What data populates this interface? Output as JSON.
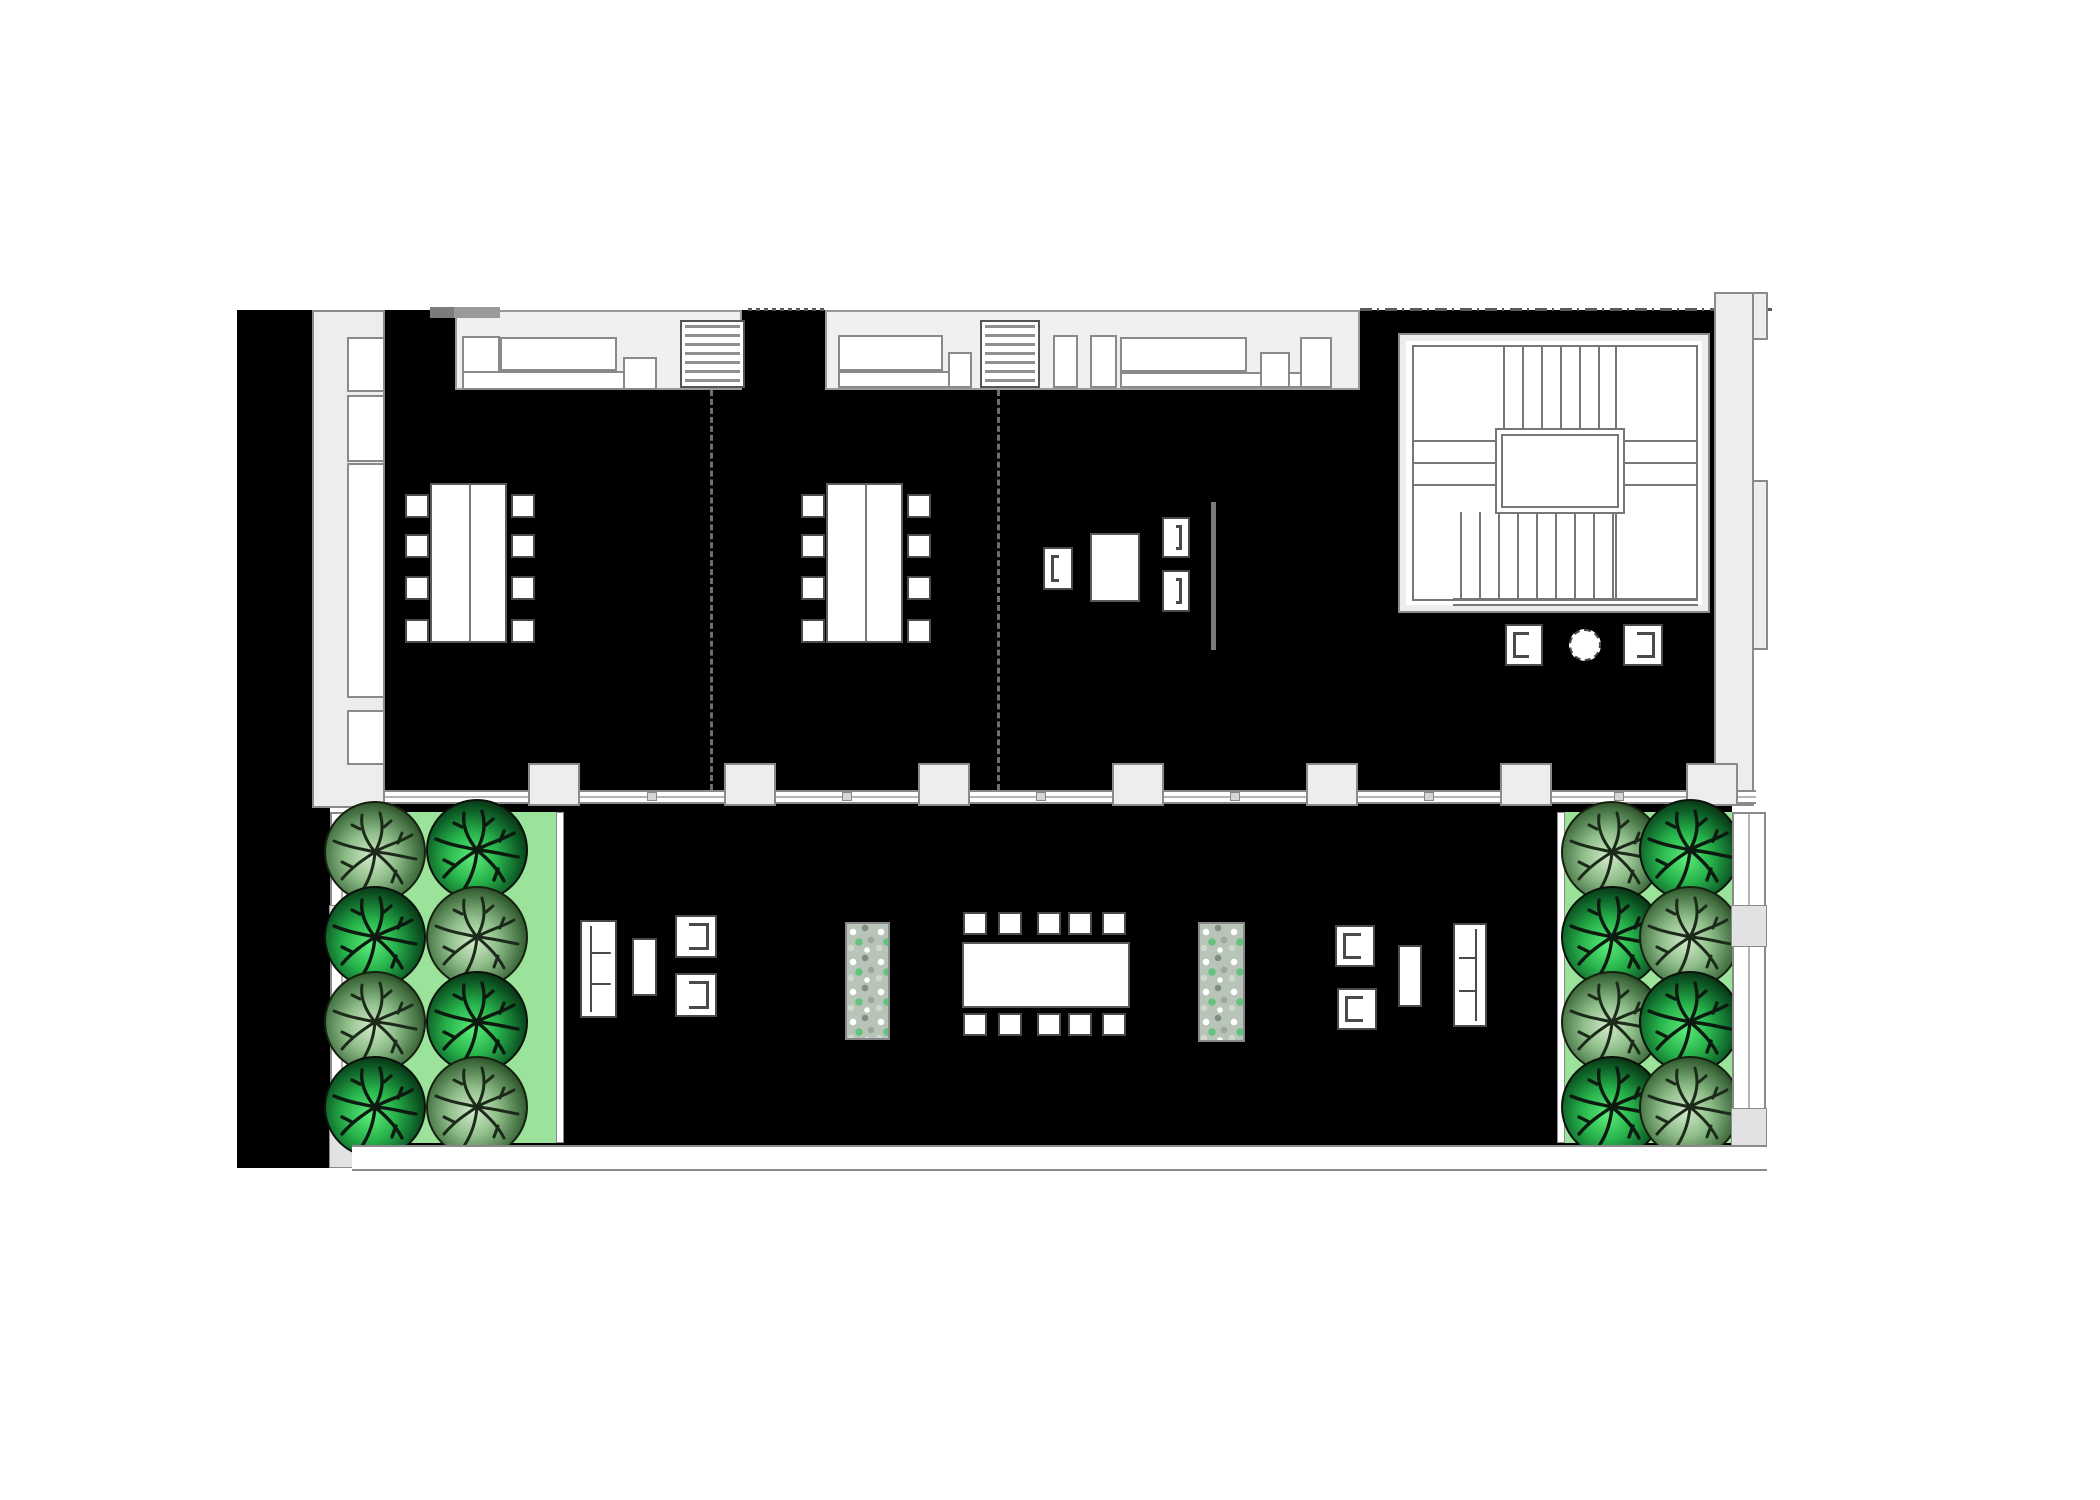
{
  "document": {
    "kind": "architectural floor plan",
    "description": "Office floor plan rendered in black poche with three rooms along the top, a U-stair core at the right, and a landscaped roof terrace below with two tree-planted lawn strips and outdoor seating"
  },
  "palette": {
    "page": "#ffffff",
    "floor_poche": "#000000",
    "wall_fill": "#ededed",
    "wall_stroke": "#8a8a8a",
    "furniture_stroke": "#4a4a4a",
    "lawn_green": "#9be39b",
    "tree_bright_green": "#27b24b",
    "tree_soft_green": "#8fbe8a"
  },
  "upper_floor": {
    "rooms": [
      {
        "id": "room-1",
        "conference_table_seats": 8,
        "kitchenette": true,
        "service_shaft": true
      },
      {
        "id": "room-2",
        "conference_table_seats": 8,
        "kitchenette": true,
        "service_shaft": true
      },
      {
        "id": "room-3",
        "armchairs": 3,
        "square_table": 1,
        "screen_wall": 1
      },
      {
        "id": "stair-hall",
        "stair_flights": 2,
        "central_landing": 1,
        "armchairs": 2,
        "round_table": 1
      }
    ],
    "left_wall_cabinets": 4,
    "window_wall_piers": 7,
    "room_dividers_dashed": 2
  },
  "terrace": {
    "lawn_strips": 2,
    "trees_total": 16,
    "trees_per_strip": 8,
    "planters": 2,
    "seating_groups": [
      {
        "id": "west-lounge",
        "items": [
          "3-seat sofa",
          "coffee table",
          "2 armchairs"
        ]
      },
      {
        "id": "dining",
        "items": [
          "long dining table",
          "10 chairs"
        ]
      },
      {
        "id": "east-lounge",
        "items": [
          "2 armchairs",
          "coffee table",
          "3-seat sofa"
        ]
      }
    ]
  }
}
